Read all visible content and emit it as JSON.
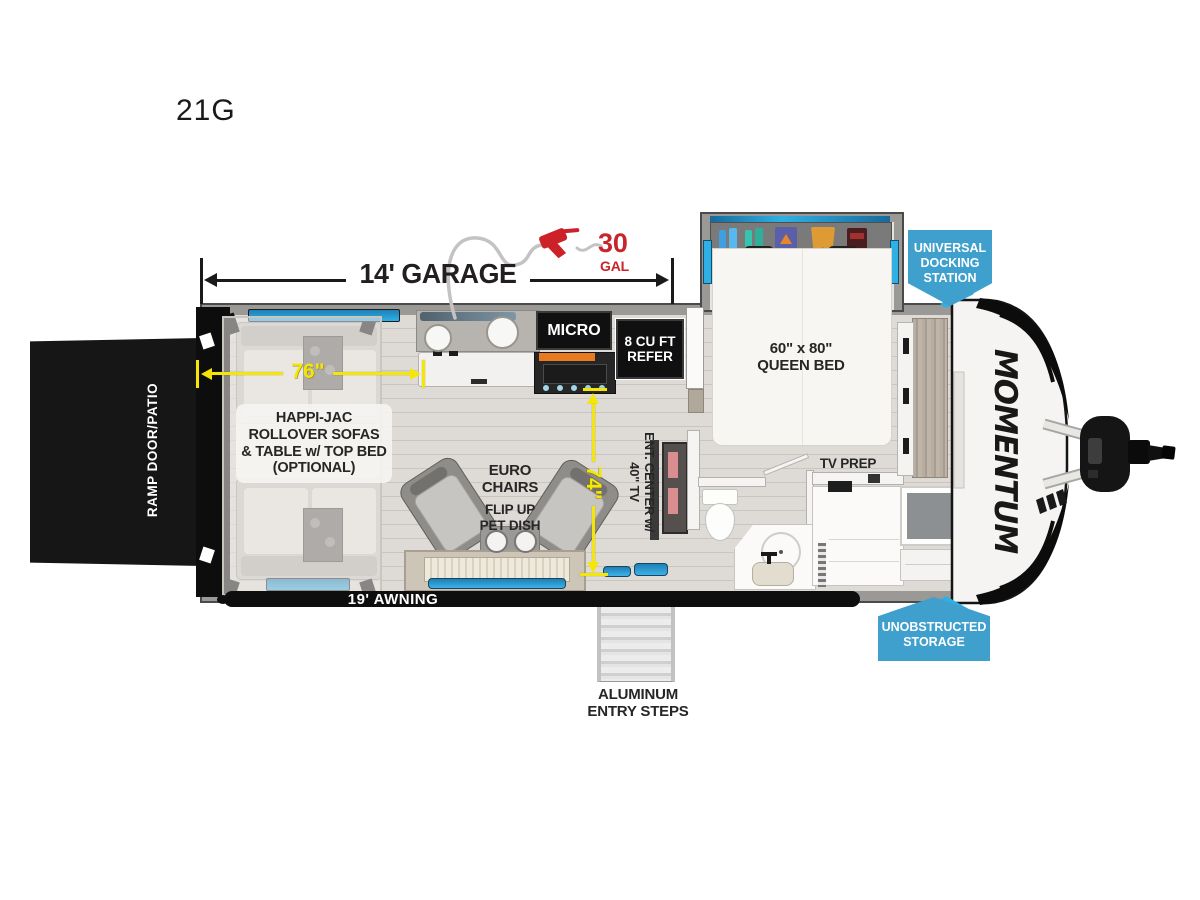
{
  "model": "21G",
  "brand_logo": "MOMENTUM",
  "dims": {
    "garage": "14' GARAGE",
    "fuel_value": "30",
    "fuel_unit": "GAL",
    "sofa_width": "76\"",
    "living_width": "74\""
  },
  "features": {
    "ramp": "RAMP DOOR/PATIO",
    "sofas": "HAPPI-JAC\nROLLOVER SOFAS\n& TABLE w/ TOP BED\n(OPTIONAL)",
    "micro": "MICRO",
    "refer": "8 CU FT\nREFER",
    "queen_bed": "60\" x 80\"\nQUEEN BED",
    "euro_chairs": "EURO\nCHAIRS",
    "pet_dish": "FLIP UP\nPET DISH",
    "ent_center": "ENT. CENTER w/\n40\" TV",
    "tv_prep": "TV PREP",
    "awning": "19' AWNING",
    "entry_steps": "ALUMINUM\nENTRY STEPS"
  },
  "badges": {
    "docking": "UNIVERSAL\nDOCKING\nSTATION",
    "storage": "UNOBSTRUCTED\nSTORAGE"
  },
  "colors": {
    "badge_blue": "#3f9fcd",
    "dimension_yellow": "#f5e60a",
    "fuel_red": "#c9232b",
    "window_blue": "#2aa9e0"
  }
}
